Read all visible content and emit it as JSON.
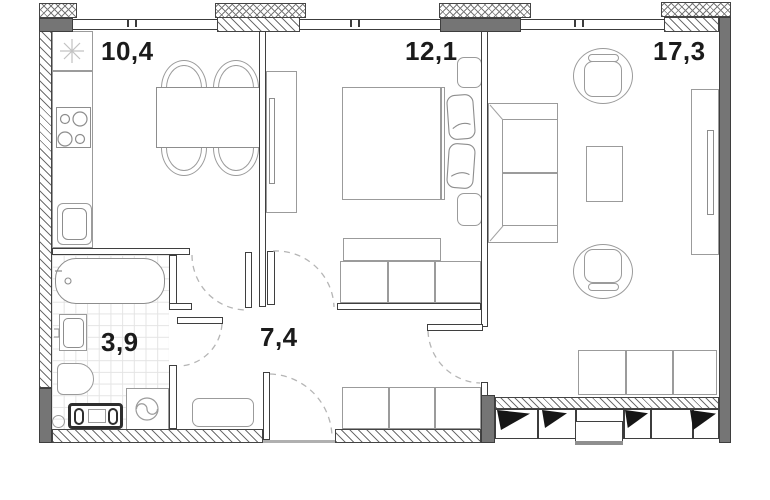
{
  "plan": {
    "title": "apartment-floor-plan",
    "rooms": [
      {
        "id": "kitchen",
        "label": "10,4",
        "fixtures": [
          "ventilation-shaft",
          "kitchen-counter",
          "stove",
          "kitchen-sink",
          "dining-table",
          "chairs"
        ]
      },
      {
        "id": "bedroom",
        "label": "12,1",
        "fixtures": [
          "wardrobe",
          "double-bed",
          "pillows",
          "nightstands",
          "dresser",
          "closet"
        ]
      },
      {
        "id": "living",
        "label": "17,3",
        "fixtures": [
          "sofa",
          "armchairs",
          "coffee-table",
          "media-cabinet",
          "window-bench",
          "panoramic-window"
        ]
      },
      {
        "id": "bathroom",
        "label": "3,9",
        "fixtures": [
          "bathtub",
          "washbasin",
          "toilet",
          "washing-machine",
          "radiator"
        ]
      },
      {
        "id": "hallway",
        "label": "7,4",
        "fixtures": [
          "bench",
          "wardrobe",
          "entrance-door"
        ]
      }
    ],
    "colors": {
      "wall_dark": "#757575",
      "wall_line": "#3f3f3f",
      "furniture_line": "#9b9b9b",
      "label_text": "#1b1b1b",
      "door_arc": "#b5b5b5",
      "tile_line": "#e4e4e4",
      "glazing_mark": "#161616"
    }
  }
}
